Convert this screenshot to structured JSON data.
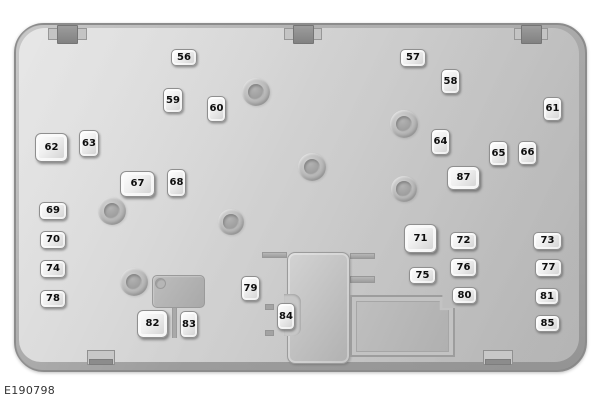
{
  "figure": {
    "code": "E190798"
  },
  "colors": {
    "panel_face": "#d0d0d0",
    "panel_edge": "#a6a6a6",
    "panel_outline": "#8c8c8c",
    "fuse_fill": "#f0f0f0",
    "fuse_border": "#8f8f8f",
    "fuse_number": "#0d0d0d",
    "boss_fill": "#a9a9a9",
    "connector_fill": "#bdbdbd"
  },
  "fuses": [
    {
      "label": "56",
      "x": 171,
      "y": 49,
      "w": 26,
      "h": 17
    },
    {
      "label": "57",
      "x": 400,
      "y": 49,
      "w": 26,
      "h": 18
    },
    {
      "label": "58",
      "x": 441,
      "y": 69,
      "w": 19,
      "h": 25
    },
    {
      "label": "59",
      "x": 163,
      "y": 88,
      "w": 20,
      "h": 25
    },
    {
      "label": "60",
      "x": 207,
      "y": 96,
      "w": 19,
      "h": 26
    },
    {
      "label": "61",
      "x": 543,
      "y": 97,
      "w": 19,
      "h": 24
    },
    {
      "label": "62",
      "x": 35,
      "y": 133,
      "w": 33,
      "h": 29,
      "large": true
    },
    {
      "label": "63",
      "x": 79,
      "y": 130,
      "w": 20,
      "h": 27
    },
    {
      "label": "64",
      "x": 431,
      "y": 129,
      "w": 19,
      "h": 26
    },
    {
      "label": "65",
      "x": 489,
      "y": 141,
      "w": 19,
      "h": 25
    },
    {
      "label": "66",
      "x": 518,
      "y": 141,
      "w": 19,
      "h": 24
    },
    {
      "label": "67",
      "x": 120,
      "y": 171,
      "w": 35,
      "h": 26,
      "large": true
    },
    {
      "label": "68",
      "x": 167,
      "y": 169,
      "w": 19,
      "h": 28
    },
    {
      "label": "87",
      "x": 447,
      "y": 166,
      "w": 33,
      "h": 24,
      "large": true
    },
    {
      "label": "69",
      "x": 39,
      "y": 202,
      "w": 28,
      "h": 18
    },
    {
      "label": "70",
      "x": 40,
      "y": 231,
      "w": 26,
      "h": 18
    },
    {
      "label": "71",
      "x": 404,
      "y": 224,
      "w": 33,
      "h": 29,
      "large": true
    },
    {
      "label": "72",
      "x": 450,
      "y": 232,
      "w": 27,
      "h": 18
    },
    {
      "label": "73",
      "x": 533,
      "y": 232,
      "w": 29,
      "h": 18
    },
    {
      "label": "74",
      "x": 40,
      "y": 260,
      "w": 26,
      "h": 18
    },
    {
      "label": "75",
      "x": 409,
      "y": 267,
      "w": 27,
      "h": 17
    },
    {
      "label": "76",
      "x": 450,
      "y": 258,
      "w": 27,
      "h": 19
    },
    {
      "label": "77",
      "x": 535,
      "y": 259,
      "w": 27,
      "h": 18
    },
    {
      "label": "78",
      "x": 40,
      "y": 290,
      "w": 26,
      "h": 18
    },
    {
      "label": "79",
      "x": 241,
      "y": 276,
      "w": 19,
      "h": 25
    },
    {
      "label": "80",
      "x": 452,
      "y": 287,
      "w": 25,
      "h": 17
    },
    {
      "label": "81",
      "x": 535,
      "y": 288,
      "w": 24,
      "h": 17
    },
    {
      "label": "82",
      "x": 137,
      "y": 310,
      "w": 31,
      "h": 28,
      "large": true
    },
    {
      "label": "83",
      "x": 180,
      "y": 311,
      "w": 18,
      "h": 27
    },
    {
      "label": "84",
      "x": 277,
      "y": 303,
      "w": 18,
      "h": 27
    },
    {
      "label": "85",
      "x": 535,
      "y": 315,
      "w": 25,
      "h": 17
    }
  ],
  "bosses": [
    {
      "x": 256,
      "y": 92,
      "r": 14
    },
    {
      "x": 404,
      "y": 124,
      "r": 14
    },
    {
      "x": 312,
      "y": 167,
      "r": 14
    },
    {
      "x": 404,
      "y": 189,
      "r": 13
    },
    {
      "x": 112,
      "y": 211,
      "r": 14
    },
    {
      "x": 231,
      "y": 222,
      "r": 13
    },
    {
      "x": 134,
      "y": 282,
      "r": 14
    }
  ],
  "top_tabs": [
    {
      "x": 48,
      "w": 39
    },
    {
      "x": 284,
      "w": 38
    },
    {
      "x": 514,
      "w": 34
    }
  ],
  "bottom_tabs": [
    {
      "x": 87,
      "w": 28
    },
    {
      "x": 483,
      "w": 30
    }
  ],
  "center_block_stubs": [
    {
      "x": 262,
      "y": 252,
      "w": 25,
      "h": 6
    },
    {
      "x": 350,
      "y": 253,
      "w": 25,
      "h": 6
    },
    {
      "x": 350,
      "y": 276,
      "w": 25,
      "h": 7
    }
  ],
  "center_block_ticks": [
    {
      "x": 265,
      "y": 304,
      "w": 9,
      "h": 6
    },
    {
      "x": 265,
      "y": 330,
      "w": 9,
      "h": 6
    }
  ]
}
